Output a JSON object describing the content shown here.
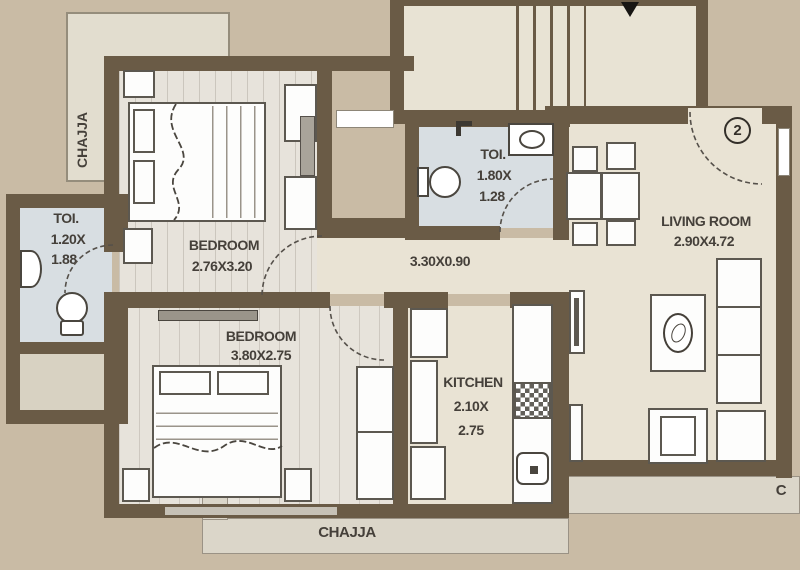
{
  "plan": {
    "unit_badge": "2",
    "rooms": {
      "bedroom1": {
        "label": "BEDROOM",
        "dims": "2.76X3.20"
      },
      "bedroom2": {
        "label": "BEDROOM",
        "dims": "3.80X2.75"
      },
      "toilet1": {
        "label": "TOI.",
        "dim1": "1.20X",
        "dim2": "1.88"
      },
      "toilet2": {
        "label": "TOI.",
        "dim1": "1.80X",
        "dim2": "1.28"
      },
      "living_room": {
        "label": "LIVING ROOM",
        "dims": "2.90X4.72"
      },
      "kitchen": {
        "label": "KITCHEN",
        "dim1": "2.10X",
        "dim2": "2.75"
      },
      "passage": {
        "dims": "3.30X0.90"
      }
    },
    "chajja": {
      "left": "CHAJJA",
      "bottom": "CHAJJA",
      "right_partial": "C"
    },
    "colors": {
      "background": "#c9bba5",
      "wall": "#6a5b46",
      "floor": "#e9e3d4",
      "toilet_floor": "#d8dee2",
      "chajja_strip": "#dbd6c9"
    }
  }
}
